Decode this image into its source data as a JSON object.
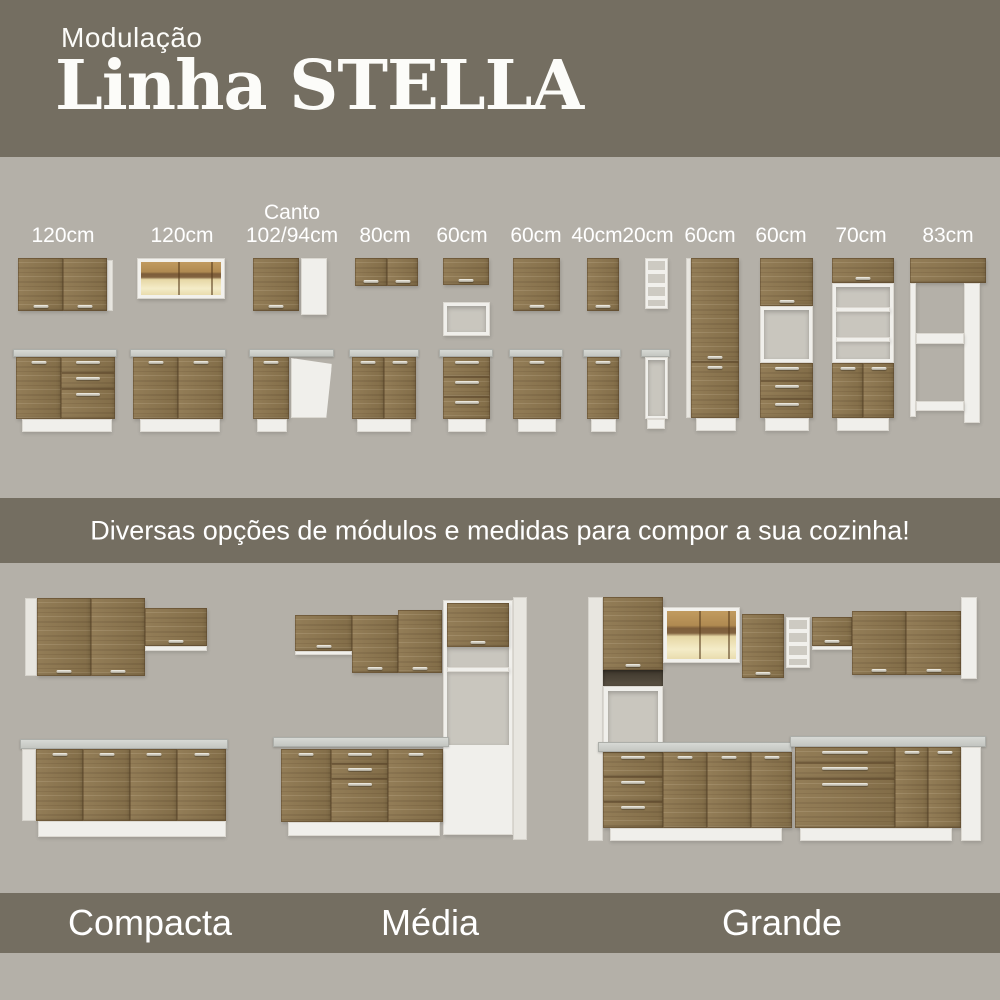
{
  "colors": {
    "band_olive": "#746e61",
    "background_gray": "#b4b0a8",
    "wood_rustic": "#8d764e",
    "cabinet_white": "#f0efeb",
    "countertop": "#c9cbc4",
    "glass_glow": "#e9d9a6",
    "text_white": "#ffffff"
  },
  "header": {
    "eyebrow": "Modulação",
    "title": "Linha STELLA"
  },
  "modules": {
    "labels": [
      {
        "top": "",
        "size": "120cm"
      },
      {
        "top": "",
        "size": "120cm"
      },
      {
        "top": "Canto",
        "size": "102/94cm"
      },
      {
        "top": "",
        "size": "80cm"
      },
      {
        "top": "",
        "size": "60cm"
      },
      {
        "top": "",
        "size": "60cm"
      },
      {
        "top": "",
        "size": "40cm"
      },
      {
        "top": "",
        "size": "20cm"
      },
      {
        "top": "",
        "size": "60cm"
      },
      {
        "top": "",
        "size": "60cm"
      },
      {
        "top": "",
        "size": "70cm"
      },
      {
        "top": "",
        "size": "83cm"
      }
    ]
  },
  "banner": {
    "text": "Diversas opções de módulos e medidas para compor a sua cozinha!"
  },
  "kitchens": {
    "items": [
      {
        "name": "Compacta"
      },
      {
        "name": "Média"
      },
      {
        "name": "Grande"
      }
    ]
  }
}
